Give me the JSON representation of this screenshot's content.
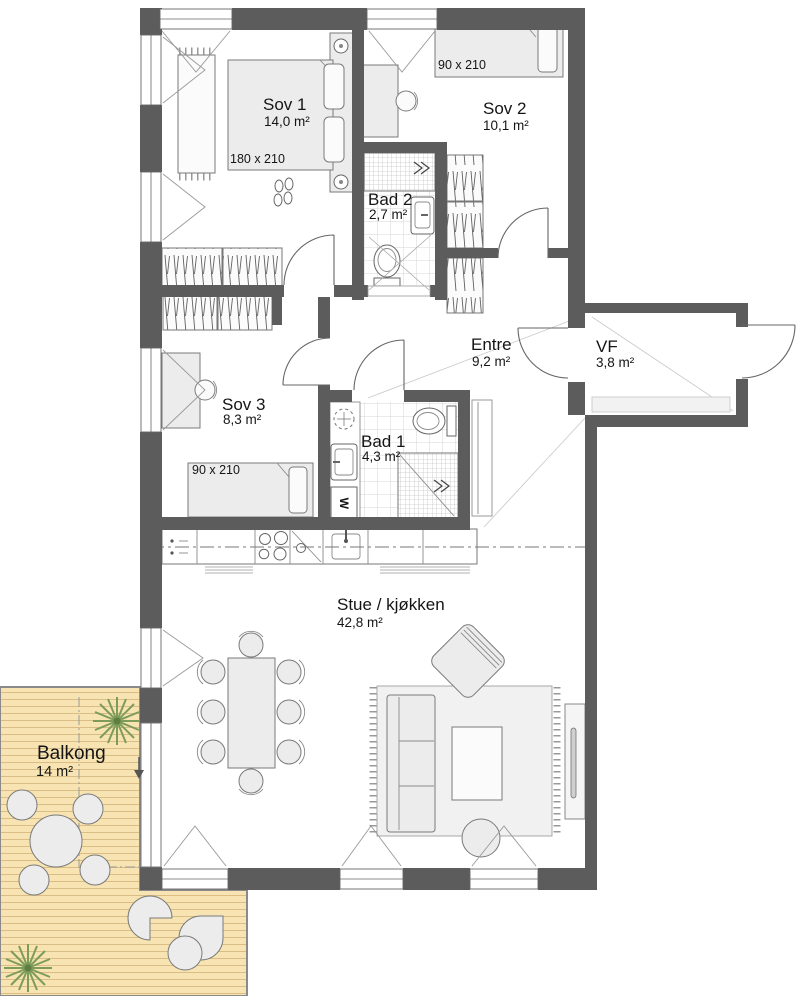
{
  "plan": {
    "title": "3-roms leilighet plantegning",
    "rooms": [
      {
        "name": "Sov 1",
        "area": "14,0 m²"
      },
      {
        "name": "Sov 2",
        "area": "10,1 m²"
      },
      {
        "name": "Bad 2",
        "area": "2,7 m²"
      },
      {
        "name": "Entre",
        "area": "9,2 m²"
      },
      {
        "name": "VF",
        "area": "3,8 m²"
      },
      {
        "name": "Sov 3",
        "area": "8,3 m²"
      },
      {
        "name": "Bad 1",
        "area": "4,3 m²"
      },
      {
        "name": "Stue / kjøkken",
        "area": "42,8 m²"
      },
      {
        "name": "Balkong",
        "area": "14 m²"
      }
    ],
    "bed_sizes": [
      {
        "room": "Sov 1",
        "label": "180 x 210"
      },
      {
        "room": "Sov 2",
        "label": "90 x 210"
      },
      {
        "room": "Sov 3",
        "label": "90 x 210"
      }
    ],
    "appliances": {
      "washer_label": "W"
    },
    "colors": {
      "wall": "#5c5c5c",
      "balcony_deck": "#f8e4b2",
      "balcony_plank": "#d9bd85",
      "plant": "#7d9c5a",
      "furniture": "#ececec",
      "outline": "#7a7a7a"
    }
  }
}
